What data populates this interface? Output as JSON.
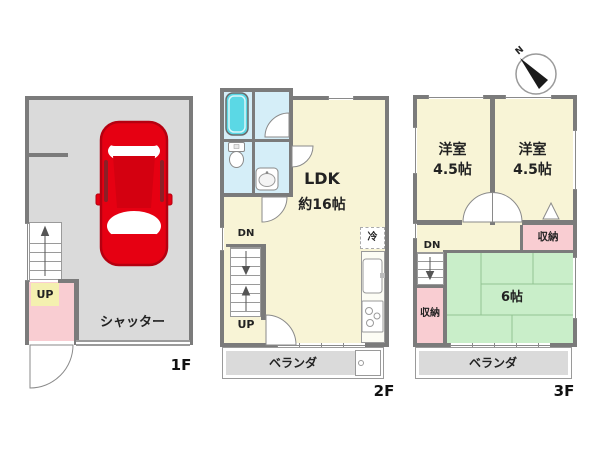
{
  "compass": {
    "north_label": "N"
  },
  "floor_1f": {
    "label": "1F",
    "garage_label": "シャッター",
    "stairs_up_label": "UP"
  },
  "floor_2f": {
    "label": "2F",
    "ldk_name": "LDK",
    "ldk_size": "約16帖",
    "fridge_label": "冷",
    "stairs_dn_label": "DN",
    "stairs_up_label": "UP",
    "balcony_label": "ベランダ"
  },
  "floor_3f": {
    "label": "3F",
    "bedroom_left_name": "洋室",
    "bedroom_left_size": "4.5帖",
    "bedroom_right_name": "洋室",
    "bedroom_right_size": "4.5帖",
    "tatami_size": "6帖",
    "closet_upper_label": "収納",
    "closet_lower_label": "収納",
    "stairs_dn_label": "DN",
    "balcony_label": "ベランダ"
  },
  "colors": {
    "wall": "#7b7b7b",
    "room_yellow": "#f8f4d6",
    "tatami_green": "#c9eec9",
    "closet_pink": "#f9cdd2",
    "bath_blue": "#d5eef8",
    "bathtub_cyan": "#5bd8e5",
    "floor_gray": "#dadada",
    "car_red": "#e60012"
  }
}
